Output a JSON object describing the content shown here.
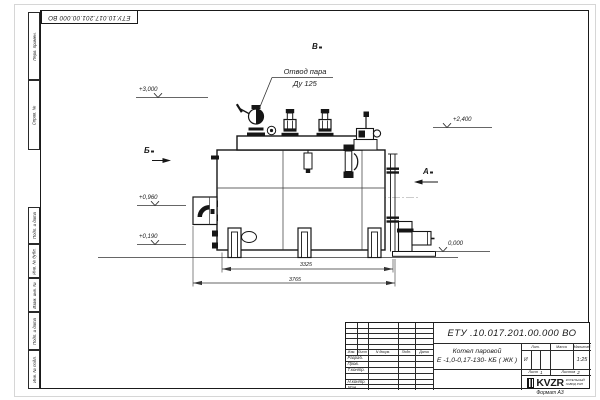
{
  "page": {
    "stamp_top": "ЕТУ.10.017.201.00.000  ВО",
    "format_note": "Формат  А3"
  },
  "margin_columns": {
    "top": [
      "Перв. примен.",
      "Справ. №"
    ],
    "bottom": [
      "Подп. и дата",
      "Инв. № дубл.",
      "Взам. инв. №",
      "Подп. и дата",
      "Инв. № подл."
    ]
  },
  "drawing": {
    "callout": {
      "line1": "Отвод пара",
      "line2": "Ду 125"
    },
    "views": {
      "a": "А",
      "b": "Б",
      "v": "В"
    },
    "elevations": {
      "e3000": "+3,000",
      "e2400": "+2,400",
      "e0960": "+0,960",
      "e0190": "+0,190",
      "e0000": "0,000"
    },
    "dimensions": {
      "inner": "3325",
      "overall": "3765"
    }
  },
  "title_block": {
    "doc_number": "ЕТУ .10.017.201.00.000  ВО",
    "product_name_1": "Котел паровой",
    "product_name_2": "Е -1,0-0,17-130- КБ ( ЖК )",
    "change_header": [
      "Изм.",
      "Лист",
      "N докум.",
      "Подп.",
      "Дата"
    ],
    "sign_rows": [
      "Разраб.",
      "Пров.",
      "Т.контр.",
      "",
      "Н.контр.",
      "Утв."
    ],
    "lit_label": "Лит.",
    "lit_value": "И",
    "mass_label": "Масса",
    "scale_label": "Масштаб",
    "scale_value": "1:25",
    "sheet_label": "Лист",
    "sheet_number": "1",
    "sheets_label": "Листов",
    "sheets_total": "2",
    "logo": {
      "name": "KVZR",
      "sub1": "КОТЕЛЬНЫЙ",
      "sub2": "ЗАВОД РЭП"
    }
  }
}
